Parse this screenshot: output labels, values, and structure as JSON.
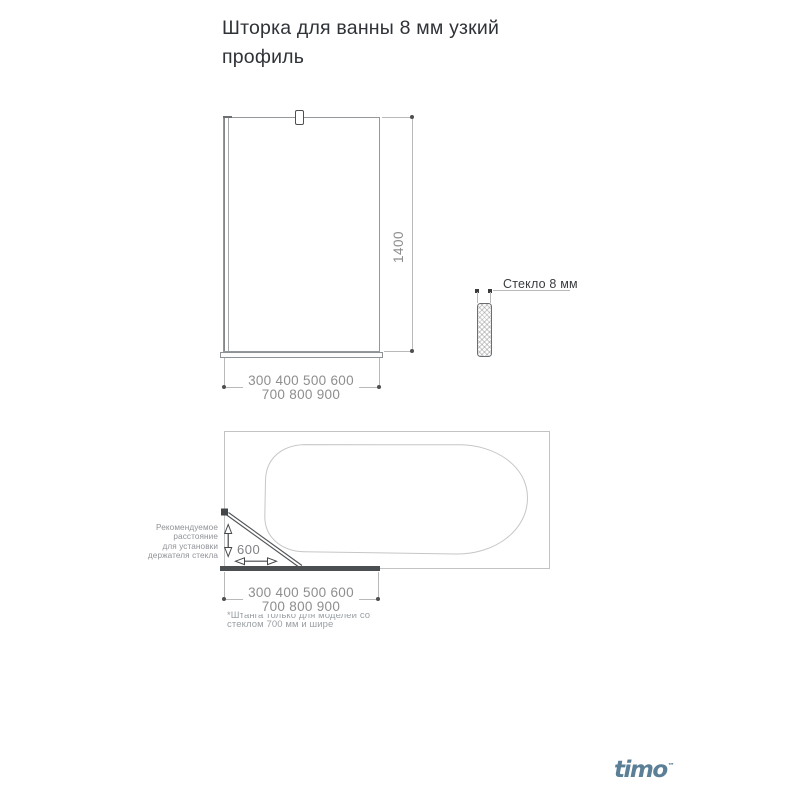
{
  "title": "Шторка для ванны 8 мм узкий профиль",
  "front_view": {
    "height_label": "1400",
    "widths_row1": "300 400 500 600",
    "widths_row2": "700 800 900"
  },
  "glass_section": {
    "label": "Стекло 8 мм"
  },
  "top_view": {
    "holder_note": [
      "Рекомендуемое",
      "расстояние",
      "для установки",
      "держателя стекла"
    ],
    "holder_distance_label": "600",
    "widths_row1": "300 400 500 600",
    "widths_row2": "700 800 900",
    "footnote_row1": "*Штанга только для моделей со",
    "footnote_row2": "стеклом 700 мм и шире"
  },
  "brand": {
    "logo_text": "timo",
    "trademark": "™"
  },
  "colors": {
    "title_text": "#2f3237",
    "dim_text": "#8e8e8e",
    "line_light": "#b9b9b9",
    "outline_gray": "#95989b",
    "dark_bar": "#4c4f52",
    "logo_blue": "#5b7f97"
  }
}
